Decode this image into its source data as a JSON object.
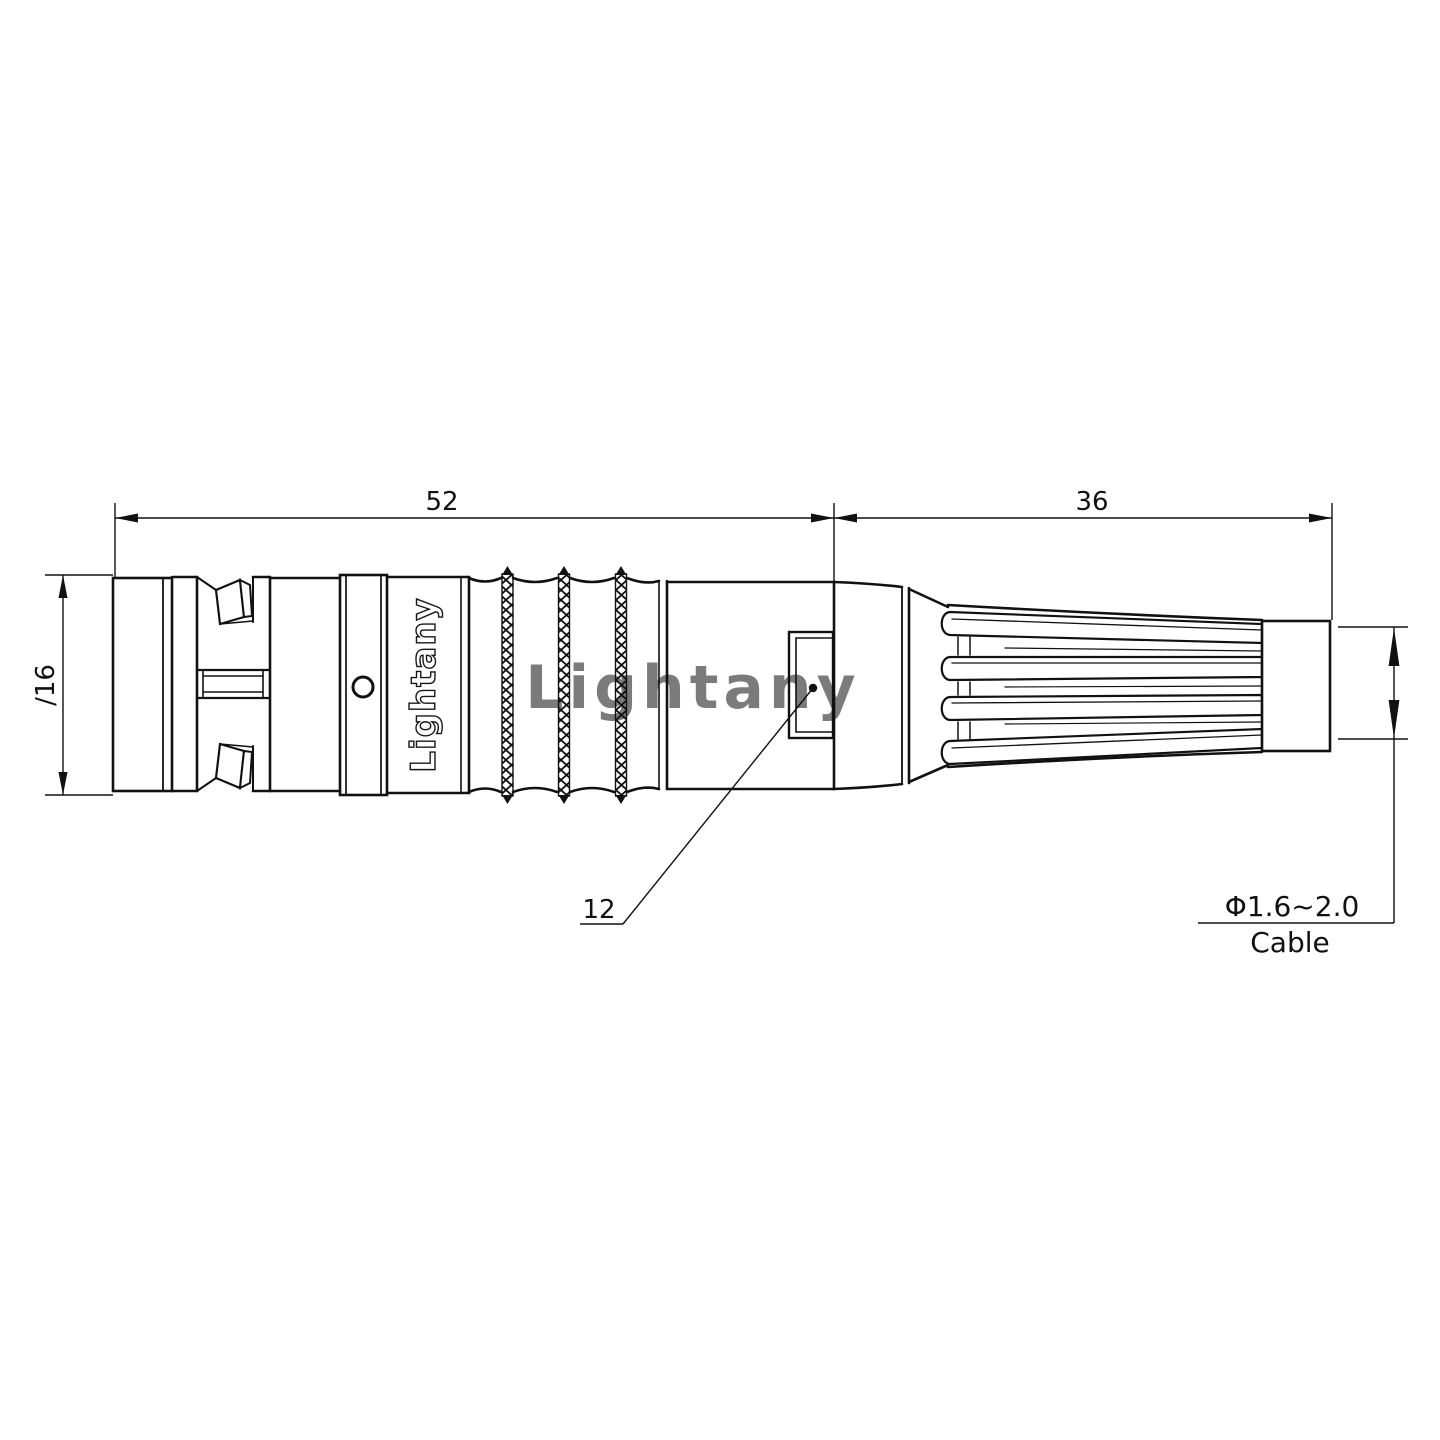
{
  "drawing": {
    "kind": "technical dimension drawing",
    "subject": "circular push-pull cable connector with strain-relief boot, side view",
    "units": "mm"
  },
  "dimensions": {
    "front_length": "52",
    "boot_length": "36",
    "body_diameter": "∕16",
    "insert_ref": "12",
    "cable_range": "Φ1.6~2.0",
    "cable_label": "Cable"
  },
  "branding": {
    "engraving": "Lightany",
    "watermark": "Lightany"
  },
  "colors": {
    "line": "#111111",
    "watermark": "#f2b6b6",
    "background": "#ffffff"
  }
}
